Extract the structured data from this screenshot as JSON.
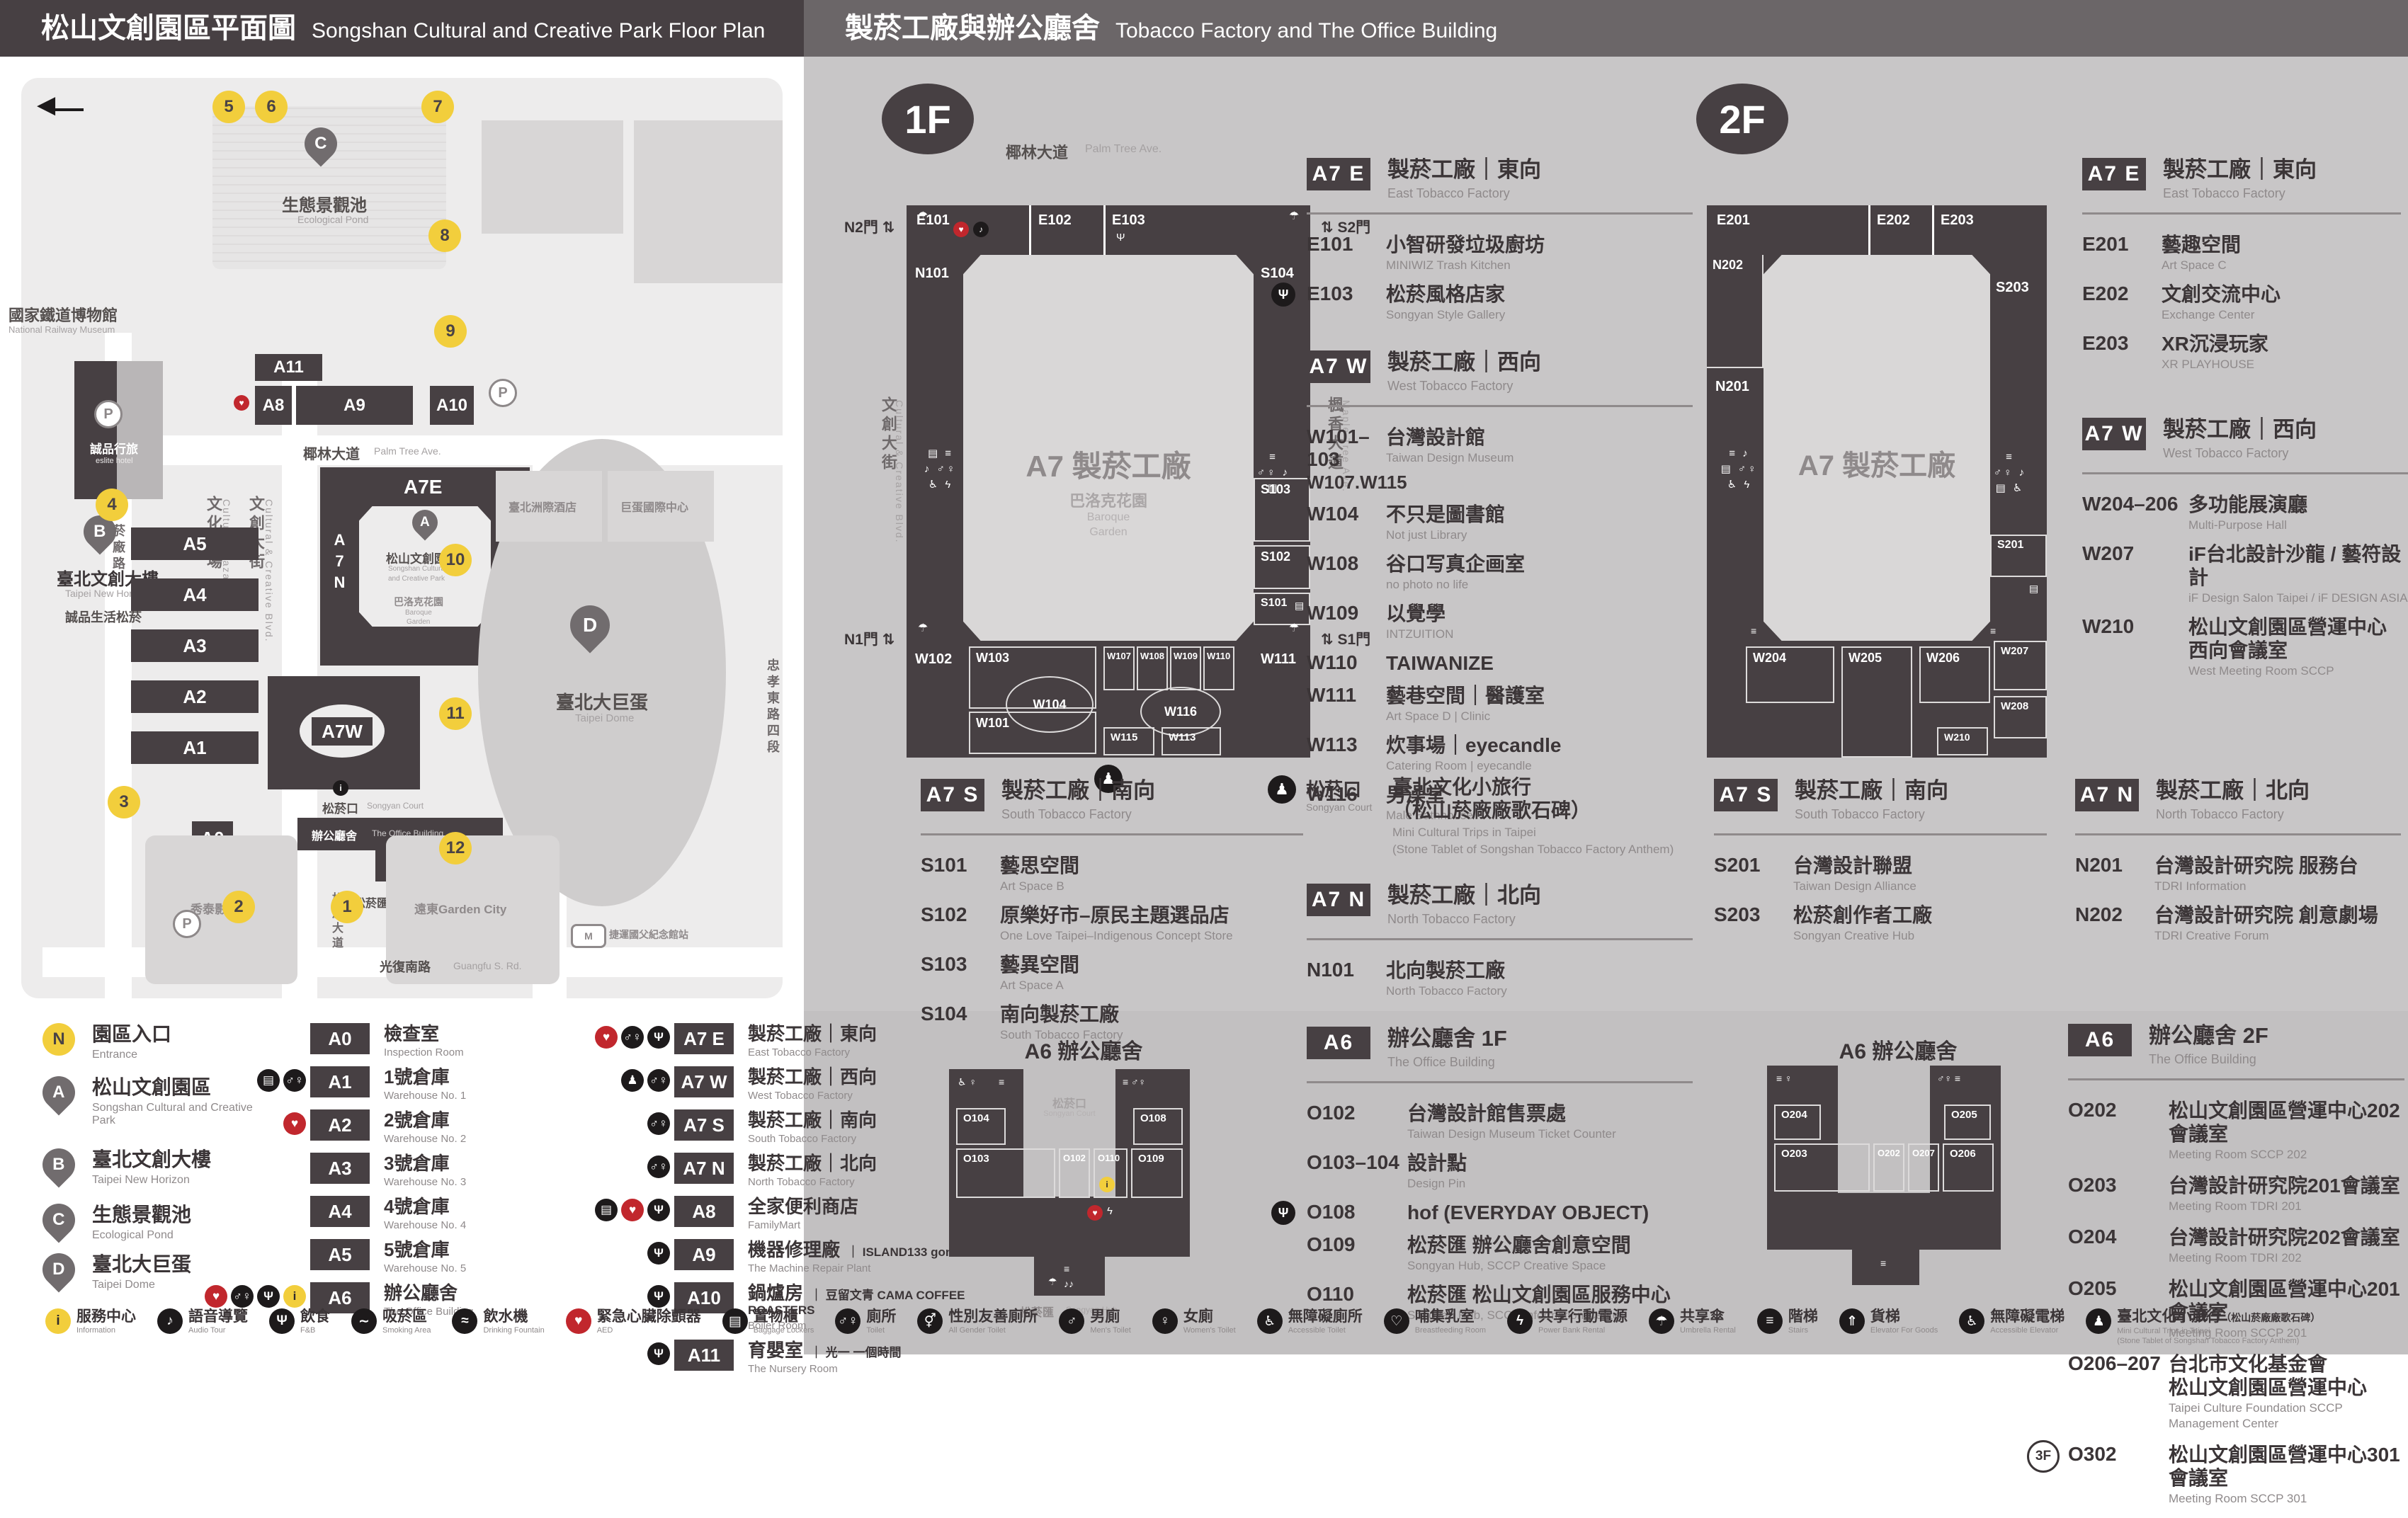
{
  "COLORS": {
    "dark": "#474043",
    "yellow": "#F2CE3C",
    "red": "#C1272D",
    "panel_gray": "#C8C6C7",
    "map_field": "#EDECEC"
  },
  "H": {
    "left_zh": "松山文創園區平面圖",
    "left_en": "Songshan Cultural and Creative Park Floor Plan",
    "right_zh": "製菸工廠與辦公廳舍",
    "right_en": "Tobacco Factory and The Office Building"
  },
  "L": {
    "north": "N",
    "map": {
      "railway_zh": "國家鐵道博物館",
      "railway_en": "National Railway Museum",
      "pond_zh": "生態景觀池",
      "pond_en": "Ecological Pond",
      "eslite_hotel_zh": "誠品行旅",
      "eslite_hotel_en": "eslite hotel",
      "horizon_zh": "臺北文創大樓",
      "horizon_en": "Taipei New Horizon",
      "spectrum_zh": "誠品生活松菸",
      "palm_zh": "椰林大道",
      "palm_en": "Palm Tree Ave.",
      "plaza_zh": "文化廣場",
      "plaza_en": "Cultural Plaza",
      "blvd_zh": "文創大街",
      "blvd_en": "Cultural & Creative Blvd.",
      "maple_zh": "楓香大道",
      "maple_en": "Maple Tree Ave.",
      "yanchang_zh": "菸廠路",
      "zhongxiao_zh": "忠孝東路四段",
      "songyan_ave_zh": "松菸大道",
      "songyan_ave_en": "Songyan Ave.",
      "guangfu_zh": "光復南路",
      "guangfu_en": "Guangfu S. Rd.",
      "sccp_zh": "松山文創園區",
      "sccp_en1": "Songshan Cultural",
      "sccp_en2": "and Creative Park",
      "baroque_zh": "巴洛克花園",
      "baroque_en1": "Baroque",
      "baroque_en2": "Garden",
      "court_zh": "松菸口",
      "court_en": "Songyan Court",
      "office_zh": "辦公廳舍",
      "office_en": "The Office Building",
      "hub_zh": "松菸匯",
      "hub_en": "Songyan Hub",
      "dome_zh": "臺北大巨蛋",
      "dome_en": "Taipei Dome",
      "hotel_zh": "臺北洲際酒店",
      "domecenter_zh": "巨蛋國際中心",
      "cinema_zh": "秀泰影城",
      "garden_zh": "遠東Garden City",
      "mrt_zh": "捷運國父紀念館站",
      "P": "P"
    },
    "blds": {
      "a11": "A11",
      "a8": "A8",
      "a9": "A9",
      "a10": "A10",
      "a7e": "A7E",
      "a7n": "A7N",
      "a7s": "A7S",
      "a7w": "A7W",
      "a5": "A5",
      "a4": "A4",
      "a3": "A3",
      "a2": "A2",
      "a1": "A1",
      "a0": "A0",
      "a6": "A6"
    },
    "entrances": [
      "1",
      "2",
      "3",
      "4",
      "5",
      "6",
      "7",
      "8",
      "9",
      "10",
      "11",
      "12"
    ],
    "pins": [
      {
        "key": "N",
        "zh": "園區入口",
        "en": "Entrance"
      },
      {
        "key": "A",
        "zh": "松山文創園區",
        "en": "Songshan Cultural and Creative Park"
      },
      {
        "key": "B",
        "zh": "臺北文創大樓",
        "en": "Taipei New Horizon"
      },
      {
        "key": "C",
        "zh": "生態景觀池",
        "en": "Ecological Pond"
      },
      {
        "key": "D",
        "zh": "臺北大巨蛋",
        "en": "Taipei Dome"
      }
    ],
    "legend1": [
      {
        "code": "A0",
        "zh": "檢查室",
        "en": "Inspection Room"
      },
      {
        "code": "A1",
        "zh": "1號倉庫",
        "en": "Warehouse No. 1",
        "icons": [
          "locker",
          "toilet"
        ]
      },
      {
        "code": "A2",
        "zh": "2號倉庫",
        "en": "Warehouse No. 2",
        "icons": [
          "aed"
        ]
      },
      {
        "code": "A3",
        "zh": "3號倉庫",
        "en": "Warehouse No. 3"
      },
      {
        "code": "A4",
        "zh": "4號倉庫",
        "en": "Warehouse No. 4"
      },
      {
        "code": "A5",
        "zh": "5號倉庫",
        "en": "Warehouse No. 5"
      },
      {
        "code": "A6",
        "zh": "辦公廳舍",
        "en": "The Office Building",
        "icons": [
          "aed",
          "toilet",
          "food",
          "info"
        ]
      }
    ],
    "legend2": [
      {
        "code": "A7 E",
        "zh": "製菸工廠｜東向",
        "en": "East Tobacco Factory",
        "icons": [
          "aed",
          "toilet",
          "food"
        ]
      },
      {
        "code": "A7 W",
        "zh": "製菸工廠｜西向",
        "en": "West Tobacco Factory",
        "icons": [
          "trip",
          "toilet"
        ]
      },
      {
        "code": "A7 S",
        "zh": "製菸工廠｜南向",
        "en": "South Tobacco Factory",
        "icons": [
          "toilet"
        ]
      },
      {
        "code": "A7 N",
        "zh": "製菸工廠｜北向",
        "en": "North Tobacco Factory",
        "icons": [
          "toilet"
        ]
      },
      {
        "code": "A8",
        "zh": "全家便利商店",
        "en": "FamilyMart",
        "icons": [
          "locker",
          "aed",
          "food"
        ]
      },
      {
        "code": "A9",
        "zh": "機器修理廠",
        "en": "The Machine Repair Plant",
        "note": "｜ ISLAND133 gonna'",
        "icons": [
          "food"
        ]
      },
      {
        "code": "A10",
        "zh": "鍋爐房",
        "en": "Boiler Room",
        "note": "｜ 豆留文青 CAMA COFFEE ROASTERS",
        "icons": [
          "food"
        ]
      },
      {
        "code": "A11",
        "zh": "育嬰室",
        "en": "The Nursery Room",
        "note": "｜ 光一 一個時間",
        "icons": [
          "food"
        ]
      }
    ]
  },
  "F1": {
    "badge": "1F",
    "palm_zh": "椰林大道",
    "palm_en": "Palm Tree Ave.",
    "blvd_zh": "文創大街",
    "blvd_en": "Cultural & Creative Blvd.",
    "maple_zh": "楓香大道",
    "maple_en": "Maple Tree Ave.",
    "center": "A7 製菸工廠",
    "baroque_zh": "巴洛克花園",
    "baroque_en1": "Baroque",
    "baroque_en2": "Garden",
    "gate_n2": "N2門",
    "gate_s2": "S2門",
    "gate_n1": "N1門",
    "gate_s1": "S1門",
    "rooms": {
      "e101": "E101",
      "e102": "E102",
      "e103": "E103",
      "n101": "N101",
      "s104": "S104",
      "s103": "S103",
      "s102": "S102",
      "s101": "S101",
      "w102": "W102",
      "w103": "W103",
      "w104": "W104",
      "w101": "W101",
      "w107": "W107",
      "w108": "W108",
      "w109": "W109",
      "w110": "W110",
      "w116": "W116",
      "w115": "W115",
      "w113": "W113",
      "w111": "W111"
    },
    "e": {
      "badge": "A7 E",
      "zh": "製菸工廠｜東向",
      "en": "East Tobacco Factory",
      "items": [
        {
          "code": "E101",
          "zh": "小智研發垃圾廚坊",
          "en": "MINIWIZ Trash Kitchen"
        },
        {
          "code": "E103",
          "zh": "松菸風格店家",
          "en": "Songyan Style Gallery",
          "icon": "food"
        }
      ]
    },
    "w": {
      "badge": "A7 W",
      "zh": "製菸工廠｜西向",
      "en": "West Tobacco Factory",
      "items": [
        {
          "code": "W101–103",
          "code2": "W107.W115",
          "zh": "台灣設計館",
          "en": "Taiwan Design Museum"
        },
        {
          "code": "W104",
          "zh": "不只是圖書館",
          "en": "Not just Library"
        },
        {
          "code": "W108",
          "zh": "谷口写真企画室",
          "en": "no photo no life"
        },
        {
          "code": "W109",
          "zh": "以覺學",
          "en": "INTZUITION"
        },
        {
          "code": "W110",
          "zh": "TAIWANIZE"
        },
        {
          "code": "W111",
          "zh": "藝巷空間｜醫護室",
          "en": "Art Space D | Clinic"
        },
        {
          "code": "W113",
          "zh": "炊事場｜eyecandle",
          "en": "Catering Room | eyecandle"
        },
        {
          "code": "W116",
          "zh": "男澡堂",
          "en": "Male Bathhouse"
        }
      ]
    },
    "s": {
      "badge": "A7 S",
      "zh": "製菸工廠｜南向",
      "en": "South Tobacco Factory",
      "items": [
        {
          "code": "S101",
          "zh": "藝思空間",
          "en": "Art Space B"
        },
        {
          "code": "S102",
          "zh": "原樂好市–原民主題選品店",
          "en": "One Love Taipei–Indigenous Concept Store"
        },
        {
          "code": "S103",
          "zh": "藝異空間",
          "en": "Art Space A"
        },
        {
          "code": "S104",
          "zh": "南向製菸工廠",
          "en": "South Tobacco Factory"
        }
      ]
    },
    "court": {
      "zh": "松菸口",
      "en": "Songyan Court",
      "n_zh1": "臺北文化小旅行",
      "n_zh2": "（松山菸廠廠歌石碑）",
      "n_en1": "Mini Cultural Trips in Taipei",
      "n_en2": "(Stone Tablet of Songshan Tobacco Factory Anthem)"
    },
    "n": {
      "badge": "A7 N",
      "zh": "製菸工廠｜北向",
      "en": "North Tobacco Factory",
      "items": [
        {
          "code": "N101",
          "zh": "北向製菸工廠",
          "en": "North Tobacco Factory"
        }
      ]
    }
  },
  "F2": {
    "badge": "2F",
    "center": "A7 製菸工廠",
    "rooms": {
      "e201": "E201",
      "e202": "E202",
      "e203": "E203",
      "n202": "N202",
      "n201": "N201",
      "s203": "S203",
      "s201": "S201",
      "w204": "W204",
      "w205": "W205",
      "w206": "W206",
      "w207": "W207",
      "w208": "W208",
      "w210": "W210"
    },
    "e": {
      "badge": "A7 E",
      "zh": "製菸工廠｜東向",
      "en": "East Tobacco Factory",
      "items": [
        {
          "code": "E201",
          "zh": "藝趣空間",
          "en": "Art Space C"
        },
        {
          "code": "E202",
          "zh": "文創交流中心",
          "en": "Exchange Center"
        },
        {
          "code": "E203",
          "zh": "XR沉浸玩家",
          "en": "XR PLAYHOUSE"
        }
      ]
    },
    "w": {
      "badge": "A7 W",
      "zh": "製菸工廠｜西向",
      "en": "West Tobacco Factory",
      "items": [
        {
          "code": "W204–206",
          "zh": "多功能展演廳",
          "en": "Multi-Purpose Hall"
        },
        {
          "code": "W207",
          "zh": "iF台北設計沙龍 / 藝符設計",
          "en": "iF Design Salon Taipei / iF DESIGN ASIA"
        },
        {
          "code": "W210",
          "zh": "松山文創園區營運中心",
          "zh2": "西向會議室",
          "en": "West Meeting Room SCCP"
        }
      ]
    },
    "s": {
      "badge": "A7 S",
      "zh": "製菸工廠｜南向",
      "en": "South Tobacco Factory",
      "items": [
        {
          "code": "S201",
          "zh": "台灣設計聯盟",
          "en": "Taiwan Design Alliance"
        },
        {
          "code": "S203",
          "zh": "松菸創作者工廠",
          "en": "Songyan Creative Hub"
        }
      ]
    },
    "n": {
      "badge": "A7 N",
      "zh": "製菸工廠｜北向",
      "en": "North Tobacco Factory",
      "items": [
        {
          "code": "N201",
          "zh": "台灣設計研究院 服務台",
          "en": "TDRI Information"
        },
        {
          "code": "N202",
          "zh": "台灣設計研究院 創意劇場",
          "en": "TDRI Creative Forum"
        }
      ]
    }
  },
  "O1": {
    "map_title": "A6 辦公廳舍",
    "court_zh": "松菸口",
    "court_en": "Songyan Court",
    "hub_zh": "松菸匯",
    "hub_en": "Songyan Hub",
    "rooms": {
      "o104": "O104",
      "o103": "O103",
      "o102": "O102",
      "o110": "O110",
      "o109": "O109",
      "o108": "O108"
    },
    "badge": "A6",
    "zh": "辦公廳舍 1F",
    "en": "The Office Building",
    "items": [
      {
        "code": "O102",
        "zh": "台灣設計館售票處",
        "en": "Taiwan Design Museum Ticket Counter"
      },
      {
        "code": "O103–104",
        "zh": "設計點",
        "en": "Design Pin"
      },
      {
        "code": "O108",
        "zh": "hof (EVERYDAY OBJECT)",
        "icon": "food"
      },
      {
        "code": "O109",
        "zh": "松菸匯 辦公廳舍創意空間",
        "en": "Songyan Hub, SCCP Creative Space"
      },
      {
        "code": "O110",
        "zh": "松菸匯 松山文創園區服務中心",
        "en": "Songyan Hub, SCCP Information Center"
      }
    ]
  },
  "O2": {
    "map_title": "A6 辦公廳舍",
    "rooms": {
      "o204": "O204",
      "o203": "O203",
      "o202": "O202",
      "o207": "O207",
      "o206": "O206",
      "o205": "O205"
    },
    "badge": "A6",
    "zh": "辦公廳舍 2F",
    "en": "The Office Building",
    "items": [
      {
        "code": "O202",
        "zh": "松山文創園區營運中心202會議室",
        "en": "Meeting Room SCCP 202"
      },
      {
        "code": "O203",
        "zh": "台灣設計研究院201會議室",
        "en": "Meeting Room TDRI 201"
      },
      {
        "code": "O204",
        "zh": "台灣設計研究院202會議室",
        "en": "Meeting Room TDRI 202"
      },
      {
        "code": "O205",
        "zh": "松山文創園區營運中心201會議室",
        "en": "Meeting Room SCCP 201"
      },
      {
        "code": "O206–207",
        "zh": "台北市文化基金會",
        "zh2": "松山文創園區營運中心",
        "en": "Taipei Culture Foundation SCCP Management Center"
      },
      {
        "prefix": "3F",
        "code": "O302",
        "zh": "松山文創園區營運中心301會議室",
        "en": "Meeting Room SCCP 301"
      }
    ]
  },
  "FAC": [
    {
      "icon": "info",
      "zh": "服務中心",
      "en": "Information"
    },
    {
      "icon": "audio",
      "zh": "語音導覽",
      "en": "Audio Tour"
    },
    {
      "icon": "food",
      "zh": "飲食",
      "en": "F&B"
    },
    {
      "icon": "smoking",
      "zh": "吸菸區",
      "en": "Smoking Area"
    },
    {
      "icon": "fountain",
      "zh": "飲水機",
      "en": "Drinking Fountain"
    },
    {
      "icon": "aed",
      "zh": "緊急心臟除顫器",
      "en": "AED"
    },
    {
      "icon": "locker",
      "zh": "置物櫃",
      "en": "Baggage Lockers"
    },
    {
      "icon": "toilet",
      "zh": "廁所",
      "en": "Toilet"
    },
    {
      "icon": "allgender",
      "zh": "性別友善廁所",
      "en": "All Gender Toilet"
    },
    {
      "icon": "men",
      "zh": "男廁",
      "en": "Men's Toilet"
    },
    {
      "icon": "women",
      "zh": "女廁",
      "en": "Women's Toilet"
    },
    {
      "icon": "accessible",
      "zh": "無障礙廁所",
      "en": "Accessible Toilet"
    },
    {
      "icon": "nursing",
      "zh": "哺集乳室",
      "en": "Breastfeeding Room"
    },
    {
      "icon": "powerbank",
      "zh": "共享行動電源",
      "en": "Power Bank Rental"
    },
    {
      "icon": "umbrella",
      "zh": "共享傘",
      "en": "Umbrella Rental"
    },
    {
      "icon": "stairs",
      "zh": "階梯",
      "en": "Stairs"
    },
    {
      "icon": "cargo",
      "zh": "貨梯",
      "en": "Elevator For Goods"
    },
    {
      "icon": "accelevator",
      "zh": "無障礙電梯",
      "en": "Accessible Elevator"
    },
    {
      "icon": "trip",
      "zh": "臺北文化小旅行",
      "zh2": "（松山菸廠廠歌石碑）",
      "en": "Mini Cultural Trips in Taipei",
      "en2": "(Stone Tablet of Songshan Tobacco Factory Anthem)"
    }
  ]
}
